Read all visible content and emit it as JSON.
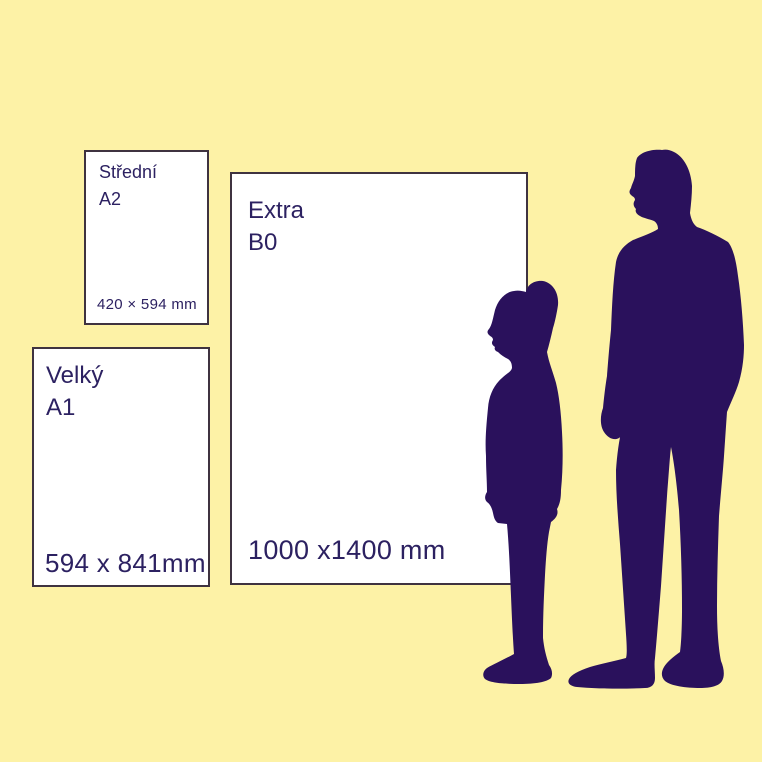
{
  "canvas": {
    "width": 762,
    "height": 764
  },
  "colors": {
    "background": "#fdf2a6",
    "ink": "#2a115c",
    "text": "#2c2161",
    "card_border": "#3f3340",
    "card_bg": "#ffffff"
  },
  "cards": [
    {
      "label": "Střední",
      "code": "A2",
      "dimensions": "420 × 594 mm"
    },
    {
      "label": "Velký",
      "code": "A1",
      "dimensions": "594 x 841mm"
    },
    {
      "label": "Extra",
      "code": "B0",
      "dimensions": "1000 x1400 mm"
    }
  ],
  "figures": [
    {
      "name": "child-silhouette"
    },
    {
      "name": "adult-man-silhouette"
    }
  ]
}
